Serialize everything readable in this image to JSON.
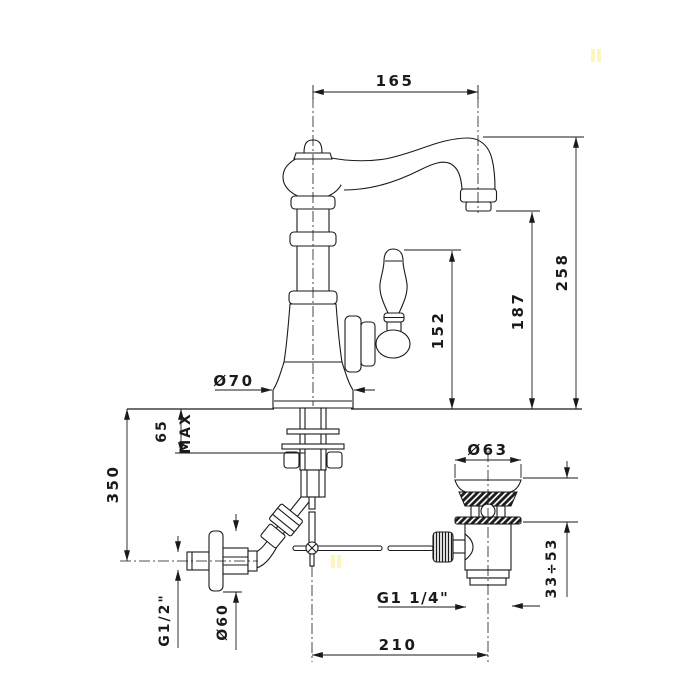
{
  "drawing": {
    "background_color": "#ffffff",
    "line_color": "#1a1a1a",
    "watermark_color": "#fbf6bc",
    "dimensions": {
      "spout_reach": "165",
      "total_height": "258",
      "spout_outlet_height": "187",
      "handle_height": "152",
      "base_diameter": "Ø70",
      "deck_max_value": "65",
      "deck_max_suffix": "MAX",
      "supply_drop": "350",
      "supply_thread": "G1/2\"",
      "escutcheon_diameter": "Ø60",
      "waste_flange_diameter": "Ø63",
      "waste_clamp_range": "33÷53",
      "waste_thread": "G1 1/4\"",
      "waste_offset": "210"
    }
  }
}
